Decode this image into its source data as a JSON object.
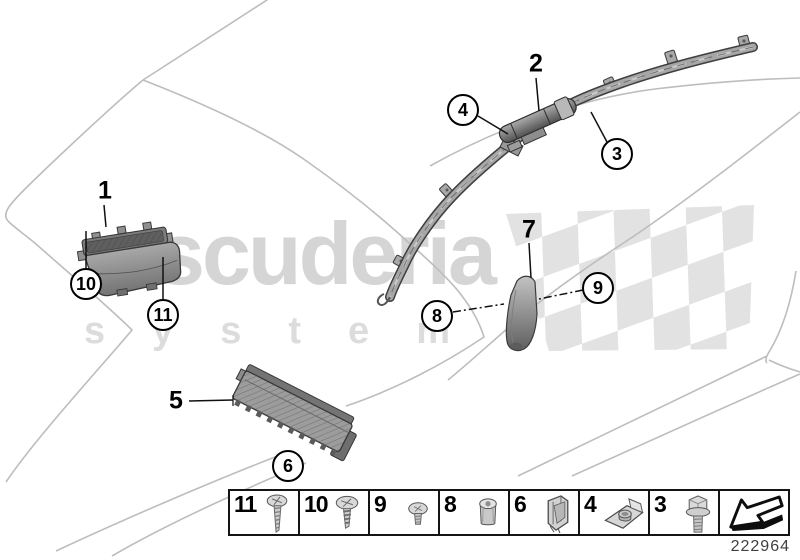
{
  "colors": {
    "background": "#ffffff",
    "car_outline": "#bdbdbd",
    "watermark_text": "#d5d5d5",
    "watermark_checker": "#e2e2e2",
    "callout_ink": "#000000",
    "part_gray": "#a6a6a6",
    "part_number_text": "#404040"
  },
  "watermark": {
    "brand": "scuderia",
    "tagline": "system"
  },
  "callouts": {
    "plain": [
      {
        "label": "1"
      },
      {
        "label": "2"
      },
      {
        "label": "5"
      },
      {
        "label": "7"
      }
    ],
    "circled": [
      {
        "label": "10"
      },
      {
        "label": "11"
      },
      {
        "label": "4"
      },
      {
        "label": "3"
      },
      {
        "label": "8"
      },
      {
        "label": "9"
      },
      {
        "label": "6"
      }
    ]
  },
  "legend": {
    "items": [
      {
        "number": "11",
        "icon": "screw-long-icon"
      },
      {
        "number": "10",
        "icon": "screw-coarse-icon"
      },
      {
        "number": "9",
        "icon": "screw-small-icon"
      },
      {
        "number": "8",
        "icon": "sleeve-nut-icon"
      },
      {
        "number": "6",
        "icon": "spring-clip-icon"
      },
      {
        "number": "4",
        "icon": "speed-nut-icon"
      },
      {
        "number": "3",
        "icon": "flange-bolt-icon"
      }
    ],
    "arrow_icon": "page-turn-arrow-icon"
  },
  "footer": {
    "drawing_number": "222964"
  }
}
